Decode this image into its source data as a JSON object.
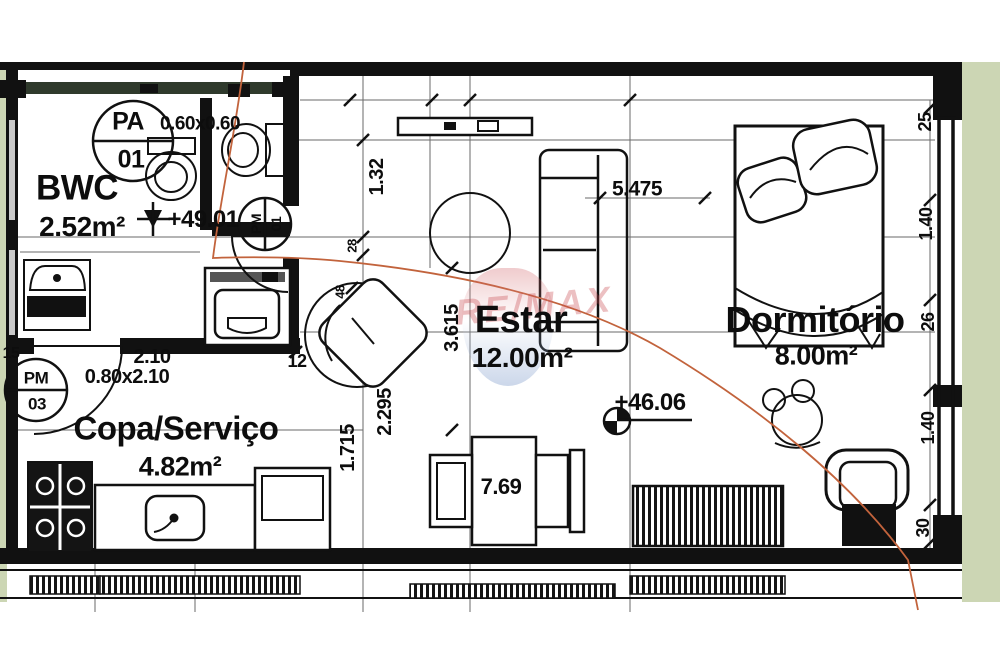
{
  "watermark": "RE/MAX",
  "rooms": {
    "bwc": {
      "name": "BWC",
      "area": "2.52m²"
    },
    "copa": {
      "name": "Copa/Serviço",
      "area": "4.82m²"
    },
    "estar": {
      "name": "Estar",
      "area": "12.00m²"
    },
    "dormitorio": {
      "name": "Dormitório",
      "area": "8.00m²"
    }
  },
  "tags": {
    "pa01": {
      "top": "PA",
      "bottom": "01"
    },
    "pm01": {
      "top": "PM",
      "bottom": "01"
    },
    "pm03": {
      "top": "PM",
      "bottom": "03"
    }
  },
  "levels": {
    "bwc": "+49.01",
    "estar": "+46.06"
  },
  "dims": {
    "bwc_window": "0.60x0.60",
    "copa_door_width": "2.10",
    "copa_door": "0.80x2.10",
    "estar_top": "1.32",
    "estar_height": "3.615",
    "estar_v1": "2.295",
    "estar_v2": "1.715",
    "estar_width": "5.475",
    "table": "7.69",
    "right_1": "25",
    "right_2": "1.40",
    "right_3": "26",
    "right_4": "1.40",
    "right_5": "30",
    "tick_12": "12",
    "tick_15": "15",
    "tick_28": "28",
    "tick_48": "48"
  },
  "colors": {
    "outside_green": "#ccd6b4",
    "section_line_red": "#c2633c",
    "wall_black": "#111111"
  }
}
